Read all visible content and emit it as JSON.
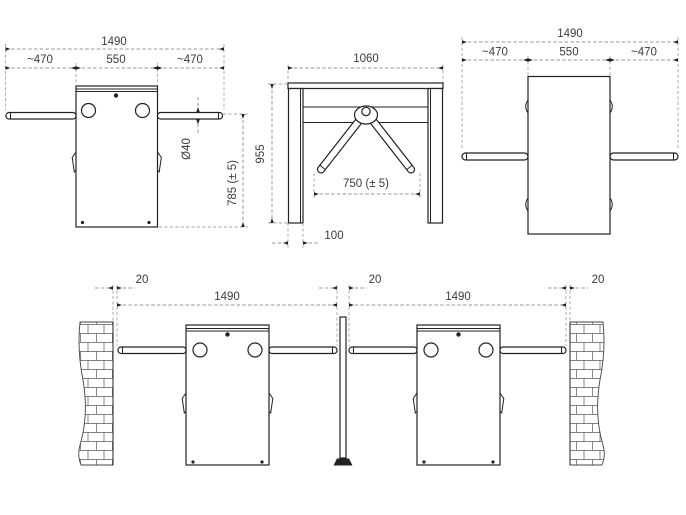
{
  "front_view": {
    "dim_total": "1490",
    "dim_left_arm": "~470",
    "dim_body": "550",
    "dim_right_arm": "~470",
    "dim_arm_diameter": "Ø40",
    "dim_height": "785 (± 5)"
  },
  "side_view": {
    "dim_width": "1060",
    "dim_height": "955",
    "dim_arm_span": "750 (± 5)",
    "dim_leg_depth": "100"
  },
  "top_view": {
    "dim_total": "1490",
    "dim_left_arm": "~470",
    "dim_body": "550",
    "dim_right_arm": "~470"
  },
  "installation_view": {
    "dim_wall_gap_left": "20",
    "dim_unit1_total": "1490",
    "dim_center_gap": "20",
    "dim_unit2_total": "1490",
    "dim_wall_gap_right": "20"
  }
}
